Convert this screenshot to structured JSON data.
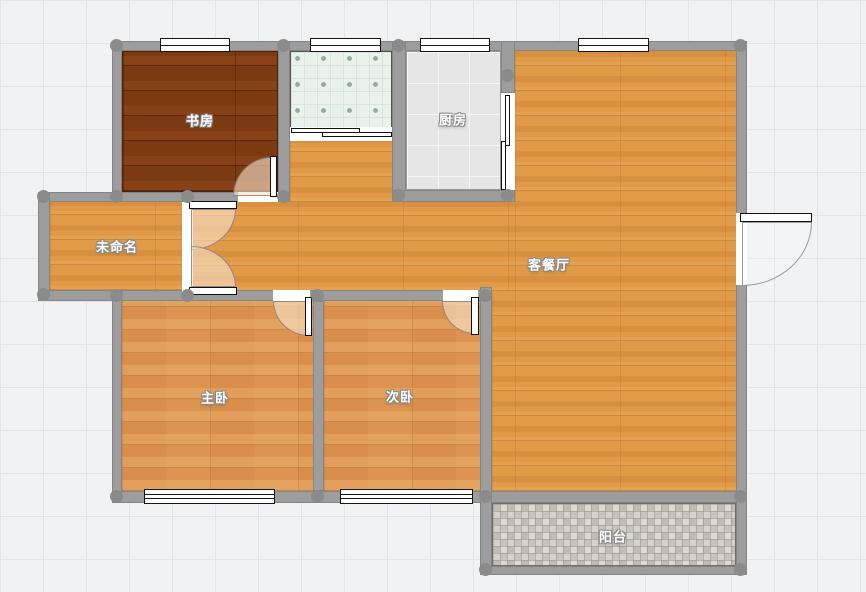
{
  "rooms": {
    "study": {
      "label": "书房"
    },
    "kitchen": {
      "label": "厨房"
    },
    "living_dining": {
      "label": "客餐厅"
    },
    "unnamed": {
      "label": "未命名"
    },
    "master_bedroom": {
      "label": "主卧"
    },
    "second_bedroom": {
      "label": "次卧"
    },
    "balcony": {
      "label": "阳台"
    }
  },
  "colors": {
    "canvas_bg": "#f0f2f3",
    "grid_line": "#e0e4e6",
    "wall": "#9d9d9d",
    "wall_node": "#8b8b8b",
    "living_floor": "#e09a48",
    "bedroom_floor": "#dc9450",
    "study_floor": "#7c3a13",
    "kitchen_tile": "#e6e6e6",
    "bathroom_tile": "#eaf2ec",
    "balcony_tile": "#d3cfc8",
    "door_swing_fill": "#f7e0c7",
    "label_text": "#ffffff"
  }
}
